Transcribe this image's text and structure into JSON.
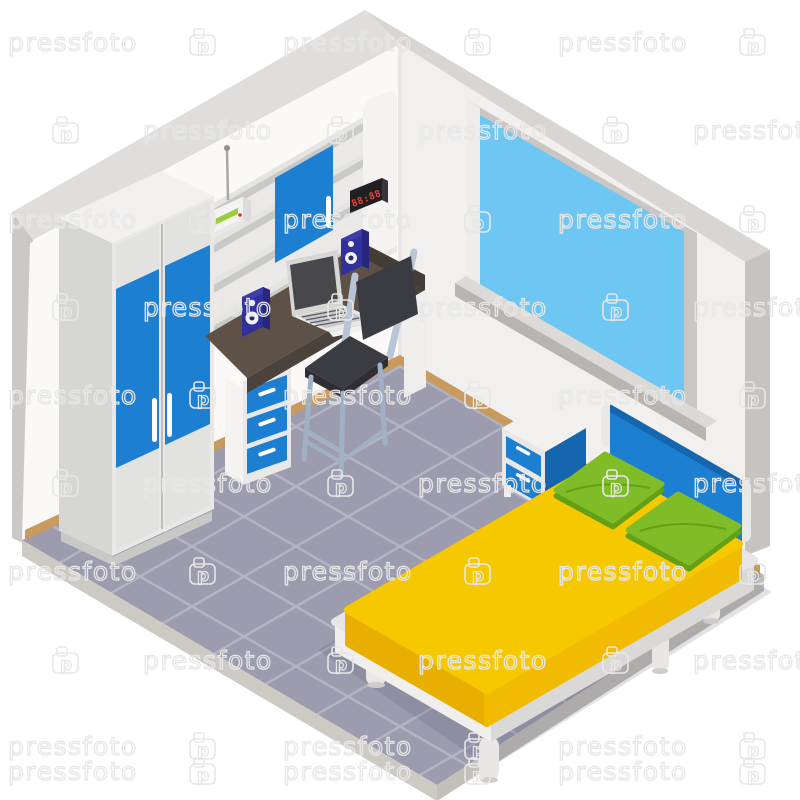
{
  "watermark": {
    "label": "pressfoto",
    "logo_letter": "p",
    "rows": [
      {
        "y": 42,
        "layout": "A"
      },
      {
        "y": 130,
        "layout": "B"
      },
      {
        "y": 219,
        "layout": "A"
      },
      {
        "y": 307,
        "layout": "B"
      },
      {
        "y": 395,
        "layout": "A"
      },
      {
        "y": 483,
        "layout": "B"
      },
      {
        "y": 571,
        "layout": "A"
      },
      {
        "y": 660,
        "layout": "B"
      },
      {
        "y": 746,
        "layout": "A"
      },
      {
        "y": 771,
        "layout": "A"
      }
    ],
    "layouts": {
      "A": [
        {
          "type": "text",
          "x": 8
        },
        {
          "type": "logo",
          "x": 190
        },
        {
          "type": "text",
          "x": 283
        },
        {
          "type": "logo",
          "x": 465
        },
        {
          "type": "text",
          "x": 558
        },
        {
          "type": "logo",
          "x": 740
        }
      ],
      "B": [
        {
          "type": "logo",
          "x": 53
        },
        {
          "type": "text",
          "x": 143
        },
        {
          "type": "logo",
          "x": 328
        },
        {
          "type": "text",
          "x": 418
        },
        {
          "type": "logo",
          "x": 603
        },
        {
          "type": "text",
          "x": 693
        }
      ]
    }
  },
  "clock": {
    "display": "88:88"
  },
  "colors": {
    "wm": "#e7e7e7",
    "wall_left": "#faf9f8",
    "wall_right": "#f2f0ee",
    "band_left": "#e0dedc",
    "band_right": "#d8d5d3",
    "edge_left": "#cbc8c5",
    "edge_right": "#c6c3c0",
    "corner": "#e9e7e5",
    "floor": "#9c9cae",
    "floor_line": "#b3b3c4",
    "rim_left": "#cdc9c3",
    "rim_right": "#c3bfb9",
    "shadow": "rgba(70,70,100,0.16)",
    "baseboard": "#c89a5e",
    "blue": "#1c7fd2",
    "blue_dark": "#1566ae",
    "furn_white": "#efeeec",
    "furn_white2": "#e9e8e6",
    "furn_side": "#d6d6d4",
    "furn_top": "#f2f1ef",
    "trim": "#e2e2e0",
    "plinth": "#c8c8c6",
    "unit_inner": "#eae9e7",
    "shelf_edge": "#c9c9c7",
    "shelf_top": "#e4e4e2",
    "panel": "#f4f3f1",
    "desk_top": "#5d5148",
    "desk_front": "#4a423b",
    "desk_edge": "#443d37",
    "navy": "#31319c",
    "navy_dark": "#26267f",
    "navy_light": "#3d3dae",
    "screen": "#48484c",
    "silver": "#d6d6d4",
    "deck": "#e8e8e6",
    "keys": "#c7c9cb",
    "key_line": "#595b60",
    "mouse": "#ccd5df",
    "chair_frame": "#b9c5d7",
    "chair_frame_dark": "#a0b1c6",
    "seat_dark": "#3b3b42",
    "seat_dark2": "#2e2e34",
    "glass": "#6ec6f2",
    "win_frame": "#c9c6c3",
    "win_frame_light": "#eeedeb",
    "sill_top": "#dcd9d6",
    "sill_front": "#b7b4b1",
    "yellow": "#f6c800",
    "yellow_light": "#f0bb00",
    "yellow_dark": "#e8ae00",
    "green": "#7fbc27",
    "green_dark": "#63a015",
    "bed_frame": "#e8e6e4",
    "bed_frame_light": "#f0efed",
    "bed_frame_dark": "#dbd9d7",
    "leg": "#e9e7e5",
    "leg_shade": "#cfccc9",
    "post": "#eae8e6",
    "clock_red": "#d93a2c",
    "clock_face": "#1f1f24",
    "clock_side": "#35353b",
    "digit": "#ef4335",
    "router_body": "#f4f3f1",
    "router_top": "#fbfbfa",
    "router_side": "#dddcda",
    "router_green": "#9ccc3f",
    "dot_red": "#e03428",
    "handle": "#ffffff"
  }
}
